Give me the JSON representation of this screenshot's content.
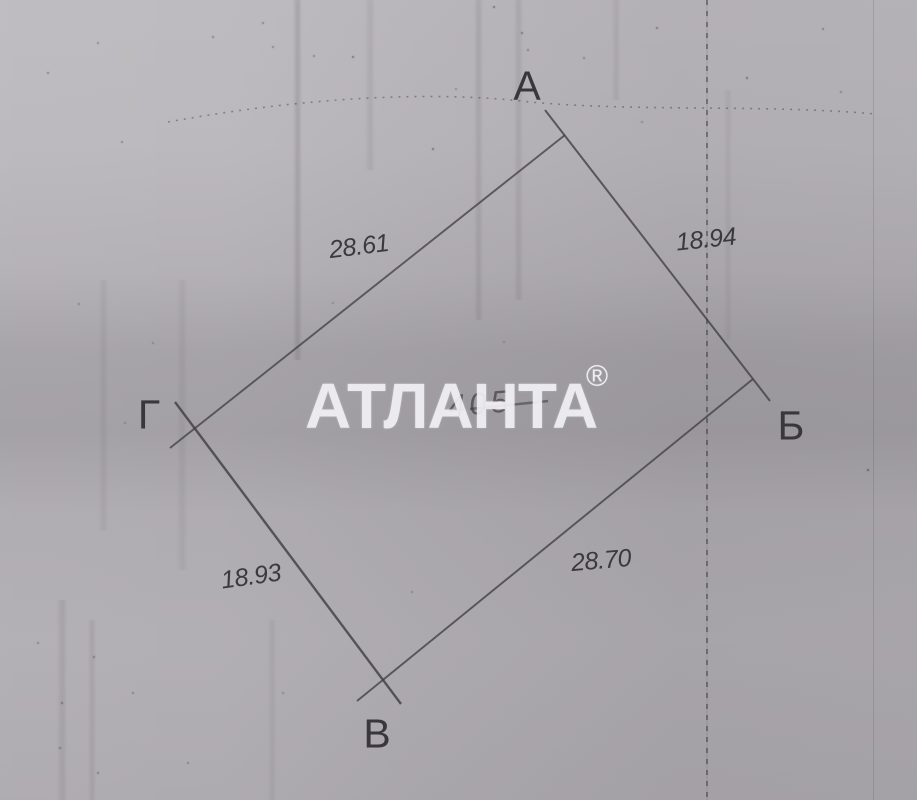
{
  "colors": {
    "paper": "#b4b1b6",
    "ink": "#3c3a40",
    "watermark_text": "#f1f0f4"
  },
  "plot_sketch": {
    "vertex_labels": [
      "А",
      "Б",
      "В",
      "Г"
    ],
    "side_measurements": [
      {
        "side": "А-Г",
        "value": "28.61"
      },
      {
        "side": "А-Б",
        "value": "18.94"
      },
      {
        "side": "Б-В",
        "value": "28.70"
      },
      {
        "side": "Г-В",
        "value": "18.93"
      }
    ]
  },
  "watermark": {
    "text": "АТЛАНТА",
    "registered_mark": "®"
  },
  "underlay_text": "405"
}
